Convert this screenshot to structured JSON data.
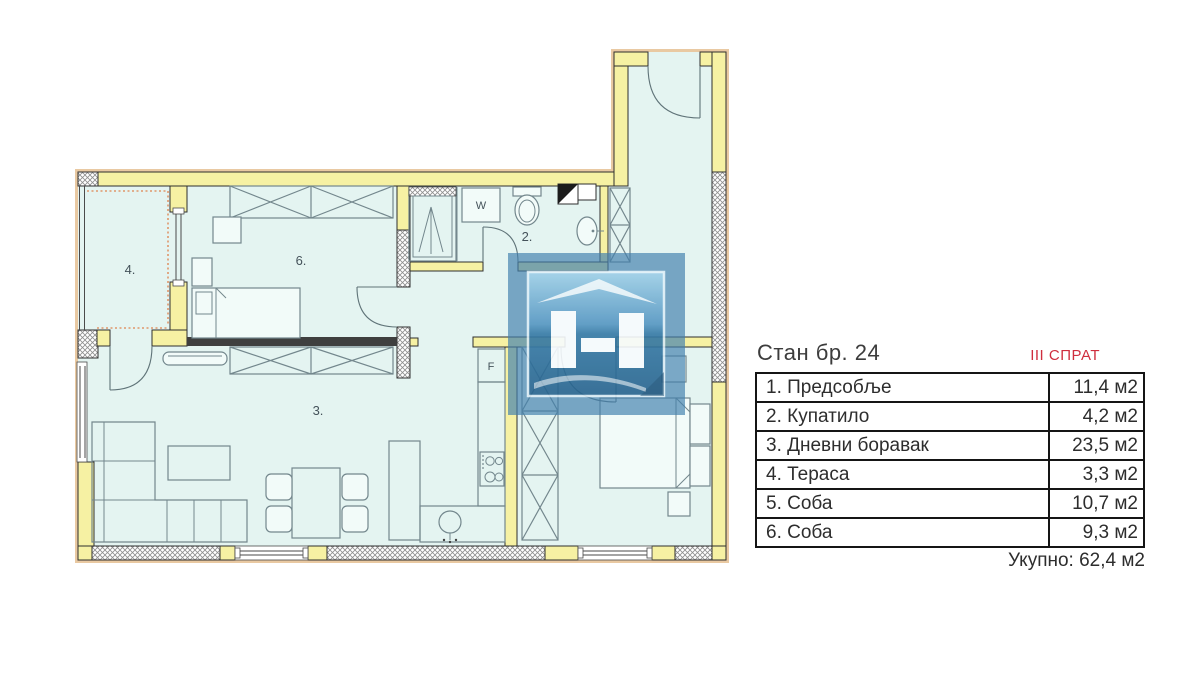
{
  "header": {
    "apartment_title": "Стан бр. 24",
    "floor_label": "III СПРАТ"
  },
  "rooms_table": {
    "rows": [
      {
        "name": "1. Предсобље",
        "area": "11,4 м2"
      },
      {
        "name": "2. Купатило",
        "area": "4,2 м2"
      },
      {
        "name": "3. Дневни боравак",
        "area": "23,5 м2"
      },
      {
        "name": "4. Тераса",
        "area": "3,3 м2"
      },
      {
        "name": "5. Соба",
        "area": "10,7 м2"
      },
      {
        "name": "6. Соба",
        "area": "9,3 м2"
      }
    ],
    "total": "Укупно: 62,4 м2"
  },
  "floor_plan": {
    "room_labels": {
      "bathroom": "2.",
      "living_room": "3.",
      "terrace": "4.",
      "bedroom": "6."
    },
    "fixture_labels": {
      "washing_machine": "W",
      "fridge": "F"
    },
    "colors": {
      "wall": "#f6f1a3",
      "floor": "#e4f4f1",
      "exterior_trim": "#e9c9a2",
      "accent_red": "#cf2e3e",
      "watermark_blue": "#4180ad"
    }
  }
}
